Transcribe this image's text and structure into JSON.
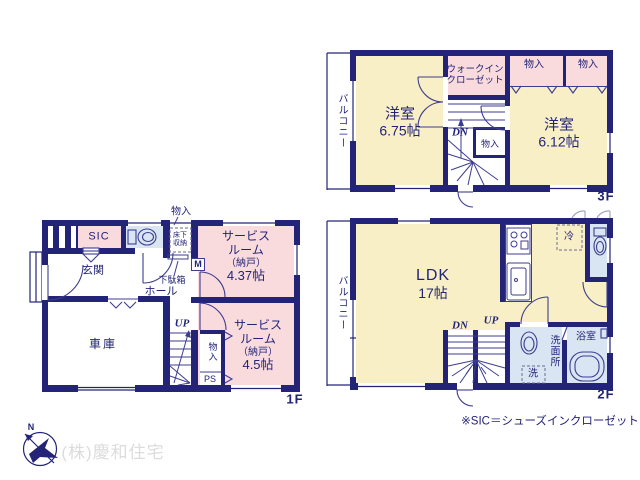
{
  "colors": {
    "wall": "#232478",
    "text": "#232478",
    "cream": "#f9efc6",
    "pink": "#f9dbde",
    "blue": "#d9e5f2",
    "line": "#3d3d8f",
    "dash": "#6a6a8e",
    "watermark": "#dcdcdc"
  },
  "floor3": {
    "label": "3F",
    "balcony": "バルコニー",
    "west_room": "洋室",
    "west_area": "6.75帖",
    "east_room": "洋室",
    "east_area": "6.12帖",
    "wic1": "ウォークイン",
    "wic2": "クローゼット",
    "closet_a": "物入",
    "closet_b": "物入",
    "closet_c": "物入",
    "dn": "DN"
  },
  "floor2": {
    "label": "2F",
    "balcony": "バルコニー",
    "ldk": "LDK",
    "ldk_area": "17帖",
    "fridge": "冷",
    "bath": "浴室",
    "washroom": "洗面所",
    "washer": "洗",
    "dn": "DN",
    "up": "UP"
  },
  "floor1": {
    "label": "1F",
    "closet_top": "物入",
    "sic": "SIC",
    "floor_storage1": "床下",
    "floor_storage2": "収納",
    "meter": "M",
    "genkan": "玄関",
    "getabako": "下駄箱",
    "hall": "ホール",
    "garage": "車庫",
    "up": "UP",
    "closet": "物入",
    "ps": "PS",
    "service1_1": "サービス",
    "service1_2": "ルーム",
    "service1_3": "（納戸）",
    "service1_area": "4.37帖",
    "service2_1": "サービス",
    "service2_2": "ルーム",
    "service2_3": "（納戸）",
    "service2_area": "4.5帖"
  },
  "footer": {
    "note": "※SIC＝シューズインクローゼット",
    "company": "(株)慶和住宅",
    "compass_n": "N"
  }
}
